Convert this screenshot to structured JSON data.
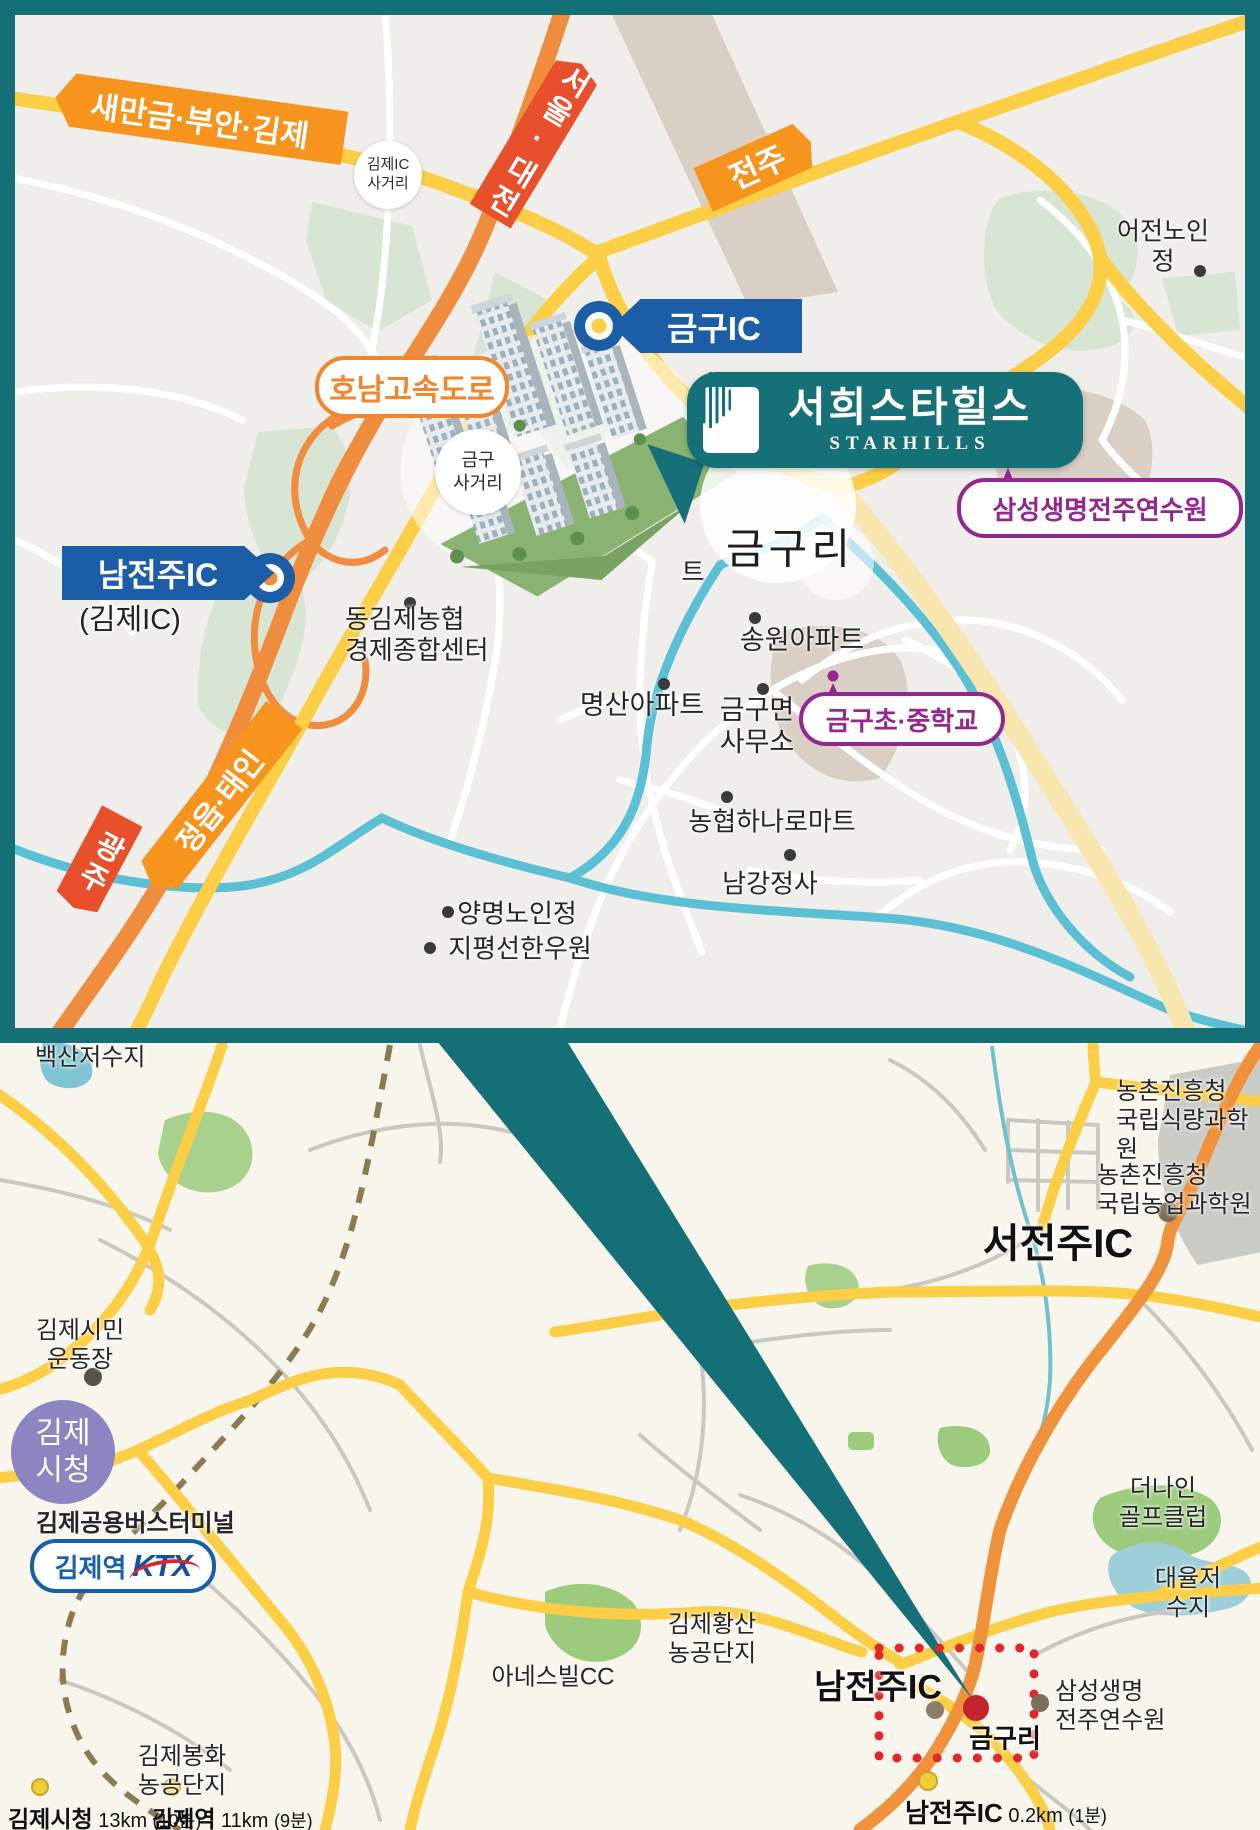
{
  "top_map": {
    "banners": {
      "saemangeum": "새만금·부안·김제",
      "seoul_daejeon": "서울·대전",
      "jeonju": "전주",
      "jeongeup_taein": "정읍·태인",
      "gwangju": "광주"
    },
    "expressway_pill": "호남고속도로",
    "ic_badges": {
      "geumgu_ic": "금구IC",
      "namjeonju_ic": "남전주IC",
      "namjeonju_ic_alias": "(김제IC)"
    },
    "junction_circles": {
      "gimje_ic": "김제IC\n사거리",
      "geumgu": "금구\n사거리"
    },
    "landmark_badge": {
      "name_ko": "서희스타힐스",
      "name_en": "STARHILLS"
    },
    "area_label": "금구리",
    "hidden_label_fragment": "트",
    "purple_pills": {
      "samsung_training": "삼성생명전주연수원",
      "geumgu_school": "금구초·중학교"
    },
    "pois": {
      "eojeon_senior": "어전노인정",
      "donggimje_nh": "동김제농협\n경제종합센터",
      "songwon_apt": "송원아파트",
      "myeongsan_apt": "명산아파트",
      "geumgu_office": "금구면\n사무소",
      "nh_hanaro_mart": "농협하나로마트",
      "namgang_jeongsa": "남강정사",
      "yangmyeong_senior": "양명노인정",
      "jipyeongseon_hanwoo": "지평선한우원"
    }
  },
  "bottom_map": {
    "labels": {
      "baeksan_reservoir": "백산저수지",
      "rda_food": "농촌진흥청\n국립식량과학원",
      "rda_agri": "농촌진흥청\n국립농업과학원",
      "seojeonju_ic": "서전주IC",
      "gimje_stadium": "김제시민\n운동장",
      "gimje_cityhall_badge": "김제\n시청",
      "gimje_bus_terminal": "김제공용버스터미널",
      "gimje_station": "김제역",
      "ktx": "KTX",
      "anesville_cc": "아네스빌CC",
      "gimje_hwangsan": "김제황산\n농공단지",
      "gimje_bonghwa": "김제봉화\n농공단지",
      "thenine_golf": "더나인\n골프클럽",
      "daeyul_reservoir": "대율저수지",
      "namjeonju_ic": "남전주IC",
      "geumguri": "금구리",
      "samsung_training": "삼성생명\n전주연수원"
    },
    "distance_bar": [
      {
        "place": "김제시청",
        "distance": "13km",
        "time": "(10분)"
      },
      {
        "place": "김제역",
        "distance": "11km",
        "time": "(9분)"
      },
      {
        "place": "남전주IC",
        "distance": "0.2km",
        "time": "(1분)"
      }
    ]
  },
  "colors": {
    "frame_teal": "#156F76",
    "banner_orange": "#F7941D",
    "banner_red": "#E84F2B",
    "ic_blue": "#1C5DA8",
    "purple": "#93278F",
    "yellow_road": "#FBCE45",
    "orange_road": "#F08C3E",
    "river_blue": "#5BC0D4",
    "red_dot": "#C4242E",
    "cityhall_lavender": "#8B85C1",
    "ktx_blue": "#1660A9",
    "ktx_red": "#D7282F"
  }
}
